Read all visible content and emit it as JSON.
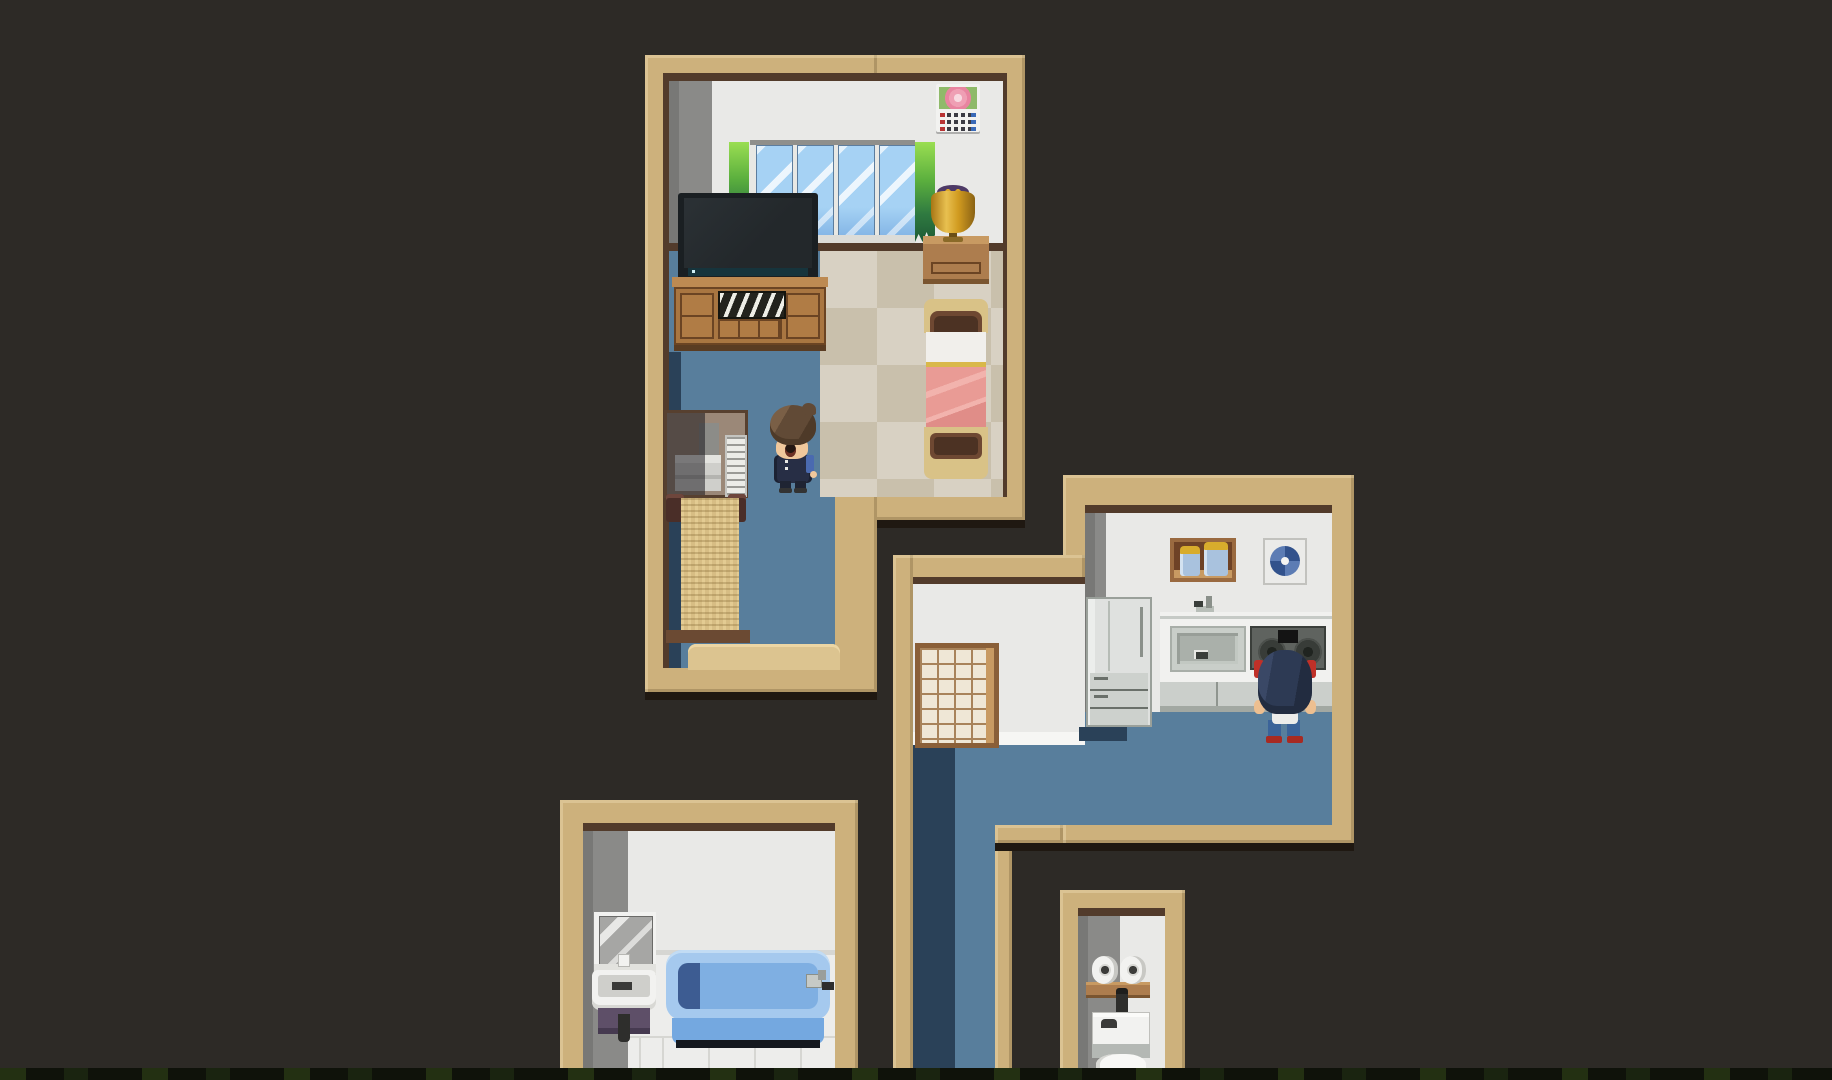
{
  "scene": {
    "title": "Top-down pixel-art house interior map",
    "type": "rpg-interior-map",
    "rooms_count": 4
  },
  "palette": {
    "bg": "#2d2a26",
    "tanWall": "#cdb17c",
    "brownLine": "#523b2b",
    "outerShadow": "#1f1811",
    "wallWhite": "#e9e9e7",
    "wallGray": "#8a8a88",
    "wallGrayDark": "#787876",
    "floorBlue": "#587e9c",
    "floorNavy": "#2a4158",
    "checkLight": "#d8d1c3",
    "checkDark": "#c9c0ac",
    "bathTile": "#ededeb",
    "tileSeam": "#d6d6d2",
    "woodMid": "#ad7d4e",
    "woodDark": "#6b4423",
    "woodLight": "#c89a62",
    "matTan": "#d7bd84",
    "stepTan": "#dcc490",
    "tvDark": "#23282b",
    "glassBlue": "#a6d2f4",
    "plantGreen": "#5cb03e",
    "bedTan": "#d9c287",
    "bedArch": "#4c3223",
    "pillowWhite": "#f1efeb",
    "blanketPink": "#e99b95",
    "goldTrim": "#d9b84a",
    "lampGold": "#d19b20",
    "lampPurple": "#4e3a66",
    "skin": "#f0c89c",
    "hairBrown": "#614a36",
    "uniformNavy": "#272e45",
    "npcNavy": "#2d3a54",
    "npcRed": "#bf3028",
    "npcJeans": "#3b6399",
    "npcShoe": "#a82a22",
    "applianceWhite": "#dfe1df",
    "counterWhite": "#f1f1ef",
    "counterFront": "#cbcfcb",
    "sinkSteel": "#aab0aa",
    "stovePanel": "#5f635f",
    "jarBlue": "#a9c2de",
    "jarLid": "#d8ac2c",
    "fanBlue": "#32528c",
    "fanBlueLight": "#5c7cb4",
    "shojiFrame": "#8a5f38",
    "shojiPane": "#efe7d6",
    "shojiLine": "#a8835a",
    "tubLight": "#a5c9ee",
    "tubInner": "#7fafe2",
    "tubDeep": "#3d5c92",
    "tubFront": "#74a8e0",
    "tubBase": "#14181e",
    "mirrorGray": "#a6a6a4",
    "basinPurple": "#5e4f68",
    "fixtureWhite": "#f2f2f0"
  },
  "rooms": {
    "bedroom": {
      "label": "Bedroom",
      "furniture": [
        "window",
        "curtain plants",
        "flower calendar",
        "flat-screen TV",
        "TV stand",
        "nightstand",
        "gold lamp",
        "bed with pink blanket",
        "desk with printer and keyboard",
        "tatami bench",
        "doorway step"
      ],
      "floor": [
        "blue carpet",
        "checkered tile"
      ]
    },
    "kitchen": {
      "label": "Kitchen",
      "furniture": [
        "shoji sliding door",
        "refrigerator",
        "jar shelf",
        "ventilation fan",
        "sink with faucet",
        "two-burner stove",
        "counter cabinets"
      ],
      "floor": [
        "blue flooring"
      ]
    },
    "hallway": {
      "label": "Hallway",
      "floor": [
        "blue flooring"
      ]
    },
    "bathroom": {
      "label": "Bathroom",
      "furniture": [
        "mirror cabinet",
        "washbasin with drain pipe",
        "blue bathtub with faucet"
      ],
      "floor": [
        "white tile"
      ]
    },
    "toilet": {
      "label": "Toilet room",
      "furniture": [
        "shelf with two toilet paper rolls",
        "toilet tank with spout",
        "toilet bowl"
      ],
      "floor": []
    }
  },
  "characters": {
    "player": {
      "label": "Player character",
      "room": "bedroom",
      "facing": "down",
      "description": "Brown-haired character in dark school uniform with surprised open mouth"
    },
    "npc": {
      "label": "Character at stove",
      "room": "kitchen",
      "facing": "up",
      "description": "Dark-haired character with red ribbons, white apron tie, jeans and red shoes cooking at the stove"
    }
  }
}
